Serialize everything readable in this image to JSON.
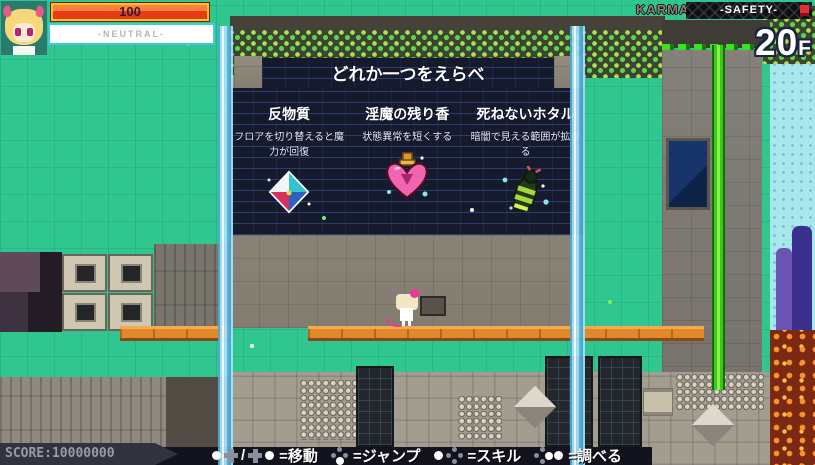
{
  "hud": {
    "hp": {
      "value": "100"
    },
    "status": {
      "label": "-NEUTRAL-"
    },
    "karma": {
      "label": "KARMA",
      "mode": "-SAFETY-"
    },
    "floor": {
      "number": "20",
      "suffix": "F"
    },
    "score": {
      "label": "SCORE:10000000"
    },
    "controls": {
      "slash": "/",
      "move": "=移動",
      "jump": "=ジャンプ",
      "skill": "=スキル",
      "examine": "=調べる"
    }
  },
  "choice_panel": {
    "title": "どれか一つをえらべ",
    "items": [
      {
        "name": "反物質",
        "description": "フロアを切り替えると魔力が回復",
        "icon": "antimatter-prism-icon"
      },
      {
        "name": "淫魔の残り香",
        "description": "状態異常を短くする",
        "icon": "heart-perfume-icon"
      },
      {
        "name": "死ねないホタル",
        "description": "暗闇で見える範囲が拡がる",
        "icon": "immortal-firefly-icon"
      }
    ]
  },
  "colors": {
    "teal_wall": "#2fc690",
    "panel_brick": "#151a2c",
    "hp_fill": "#e84418",
    "hp_frame": "#f0c828",
    "status_border": "#40c8e0",
    "waterfall": "#a6e2f6",
    "platform_orange": "#e0882c",
    "hud_bar": "#12131d",
    "accent_green": "#5ad648"
  }
}
